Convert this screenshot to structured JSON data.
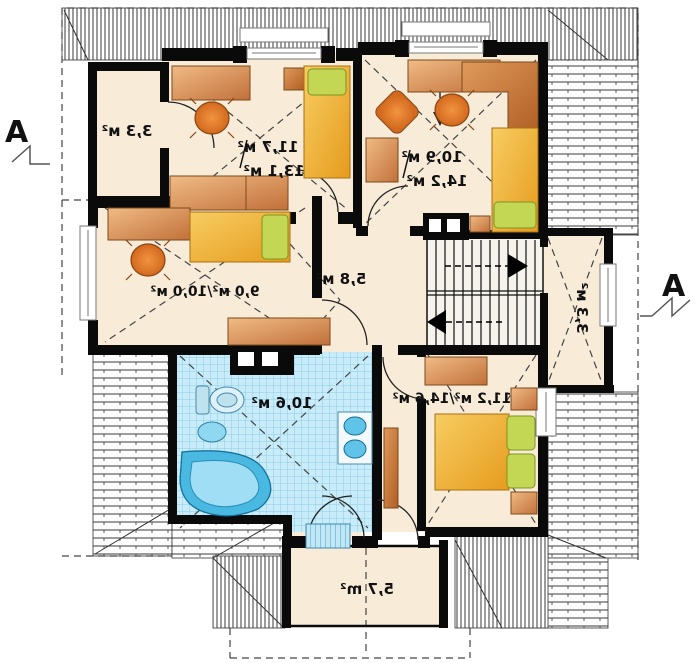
{
  "plan": {
    "markers": {
      "left": "A",
      "right": "A"
    },
    "labels": {
      "closet_top_left": "3,3 м²",
      "bedroom_top_center_line1": "11,7 м²",
      "bedroom_top_center_line2": "13,1 м²",
      "bedroom_top_right_line1": "10,9 м²",
      "bedroom_top_right_line2": "14,2 м²",
      "bedroom_mid_left": "9,0 м²/10,0 м²",
      "hall": "5,8 м²",
      "storage_right": "3,3 м²",
      "bathroom": "10,6 м²",
      "bedroom_bottom_right": "11,2 м²/14,6 м²",
      "balcony": "5,7 m²"
    },
    "colors": {
      "wall": "#0a0a0a",
      "floor": "#f8ecd9",
      "bathroom_tile": "#c8ecf9",
      "wood": "#d2884a",
      "bed_yellow": "#f2b840",
      "pillow_green": "#c3d755",
      "chair_orange": "#e5761b",
      "fixture_blue": "#5fc4e8",
      "hatch_line": "#3a3a3a"
    },
    "note_text_mirrored": true
  }
}
